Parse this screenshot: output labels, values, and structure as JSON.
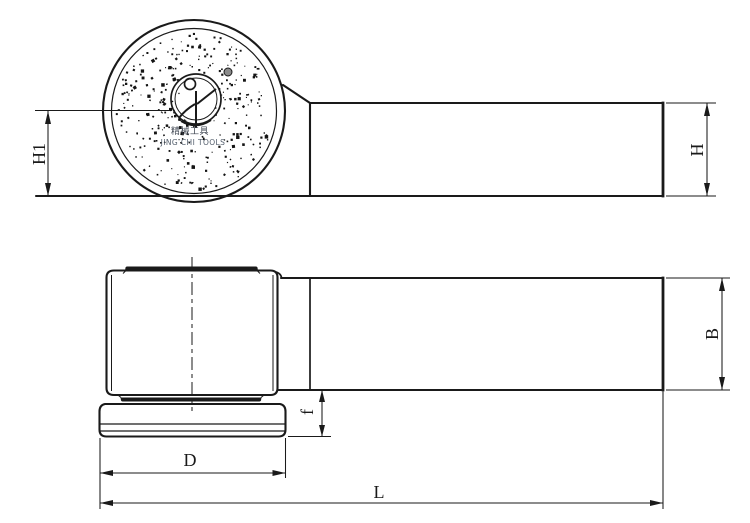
{
  "drawing": {
    "labels": {
      "h1": "H1",
      "h": "H",
      "b": "B",
      "f": "f",
      "d": "D",
      "l": "L"
    },
    "brand": {
      "line1": "精械工具",
      "line2": "JING CHI TOOLS"
    },
    "colors": {
      "line": "#1a1a1a",
      "background": "#ffffff",
      "spindle_dot": "#8a8a8a"
    }
  }
}
